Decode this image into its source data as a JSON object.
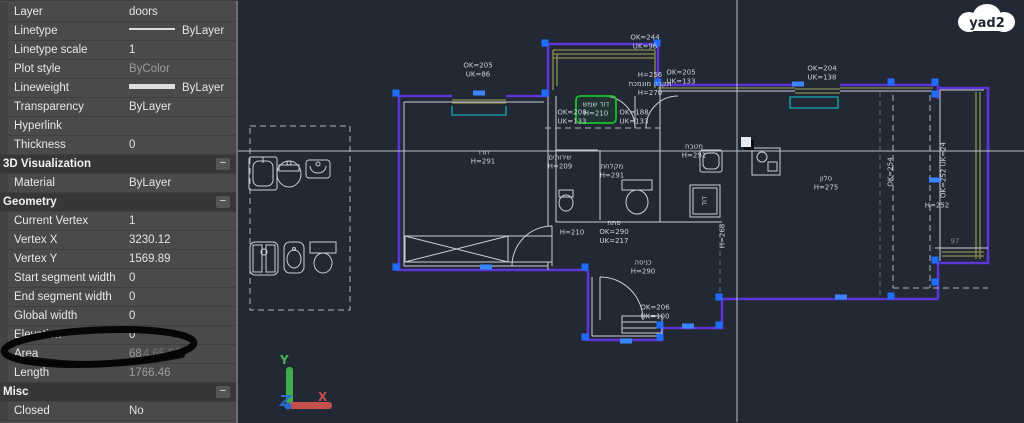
{
  "brand": {
    "logo_text": "yad2"
  },
  "panel": {
    "rows": [
      {
        "type": "row",
        "label": "Layer",
        "value": "doors"
      },
      {
        "type": "row",
        "label": "Linetype",
        "value": "ByLayer",
        "swatch": "thin"
      },
      {
        "type": "row",
        "label": "Linetype scale",
        "value": "1"
      },
      {
        "type": "row",
        "label": "Plot style",
        "value": "ByColor",
        "dim": true
      },
      {
        "type": "row",
        "label": "Lineweight",
        "value": "ByLayer",
        "swatch": "thick"
      },
      {
        "type": "row",
        "label": "Transparency",
        "value": "ByLayer"
      },
      {
        "type": "row",
        "label": "Hyperlink",
        "value": ""
      },
      {
        "type": "row",
        "label": "Thickness",
        "value": "0"
      },
      {
        "type": "header",
        "label": "3D Visualization",
        "collapse": "−"
      },
      {
        "type": "row",
        "label": "Material",
        "value": "ByLayer"
      },
      {
        "type": "header",
        "label": "Geometry",
        "collapse": "−"
      },
      {
        "type": "row",
        "label": "Current Vertex",
        "value": "1"
      },
      {
        "type": "row",
        "label": "Vertex X",
        "value": "3230.12"
      },
      {
        "type": "row",
        "label": "Vertex Y",
        "value": "1569.89"
      },
      {
        "type": "row",
        "label": "Start segment width",
        "value": "0"
      },
      {
        "type": "row",
        "label": "End segment width",
        "value": "0"
      },
      {
        "type": "row",
        "label": "Global width",
        "value": "0"
      },
      {
        "type": "row",
        "label": "Elevation",
        "value": "0"
      },
      {
        "type": "row",
        "label": "Area",
        "value": "68",
        "value_tail": "4.65.55",
        "dim": true
      },
      {
        "type": "row",
        "label": "Length",
        "value": "1766.46",
        "dim": true
      },
      {
        "type": "header",
        "label": "Misc",
        "collapse": "−"
      },
      {
        "type": "row",
        "label": "Closed",
        "value": "No"
      }
    ]
  },
  "plan": {
    "labels": [
      {
        "x": 478,
        "y": 70,
        "lines": [
          "OK=205",
          "UK=86"
        ]
      },
      {
        "x": 645,
        "y": 42,
        "lines": [
          "OK=244",
          "UK=96"
        ]
      },
      {
        "x": 650,
        "y": 84,
        "lines": [
          "H=256",
          "תקרה מונמכת",
          "H=270"
        ]
      },
      {
        "x": 681,
        "y": 77,
        "lines": [
          "OK=205",
          "UK=133"
        ]
      },
      {
        "x": 822,
        "y": 73,
        "lines": [
          "OK=204",
          "UK=138"
        ]
      },
      {
        "x": 572,
        "y": 117,
        "lines": [
          "OK=208",
          "UK=133"
        ]
      },
      {
        "x": 634,
        "y": 117,
        "lines": [
          "OK=188",
          "UK=133"
        ]
      },
      {
        "x": 483,
        "y": 157,
        "lines": [
          "חדר",
          "H=291"
        ]
      },
      {
        "x": 560,
        "y": 162,
        "lines": [
          "שירותים",
          "H=209"
        ]
      },
      {
        "x": 612,
        "y": 171,
        "lines": [
          "מקלחת",
          "H=291"
        ]
      },
      {
        "x": 596,
        "y": 109,
        "lines": [
          "דוד שמש",
          "H=210"
        ]
      },
      {
        "x": 694,
        "y": 151,
        "lines": [
          "מטבח",
          "H=291"
        ]
      },
      {
        "x": 826,
        "y": 183,
        "lines": [
          "סלון",
          "H=275"
        ]
      },
      {
        "x": 937,
        "y": 206,
        "lines": [
          "H=252"
        ]
      },
      {
        "x": 572,
        "y": 233,
        "lines": [
          "H=210"
        ]
      },
      {
        "x": 614,
        "y": 232,
        "lines": [
          "פתח",
          "OK=290",
          "UK=217"
        ]
      },
      {
        "x": 643,
        "y": 267,
        "lines": [
          "כניסה",
          "H=290"
        ]
      },
      {
        "x": 655,
        "y": 312,
        "lines": [
          "OK=206",
          "UK=100"
        ]
      },
      {
        "x": 723,
        "y": 236,
        "rot": true,
        "lines": [
          "H=268"
        ]
      },
      {
        "x": 705,
        "y": 201,
        "rot": true,
        "lines": [
          "דוד"
        ]
      },
      {
        "x": 891,
        "y": 172,
        "rot": true,
        "lines": [
          "OK=254"
        ]
      },
      {
        "x": 944,
        "y": 170,
        "rot": true,
        "lines": [
          "OK=252 UK=24"
        ]
      },
      {
        "x": 955,
        "y": 242,
        "lines": [
          "97"
        ],
        "dim": true
      }
    ],
    "colors": {
      "wall": "#5b35d6",
      "trim": "#8d8d52",
      "glass": "#15aab2",
      "grip": "#1e6dff",
      "sel": "#17c02c",
      "bg": "#222834",
      "crosshair": "#b9c2cc"
    }
  },
  "ucs": {
    "x": "X",
    "y": "Y"
  }
}
